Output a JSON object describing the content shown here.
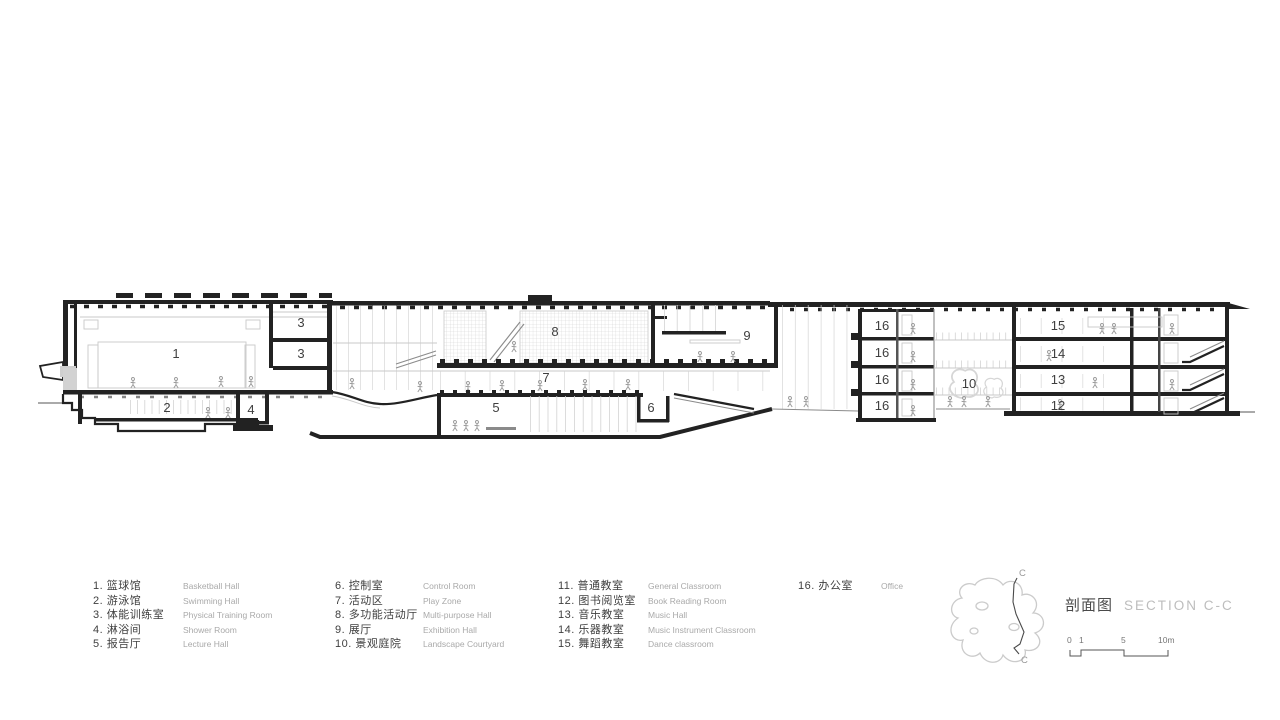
{
  "title": {
    "zh": "剖面图",
    "en": "SECTION C-C"
  },
  "legend": {
    "items": [
      {
        "label": "1. 篮球馆",
        "en": "Basketball Hall"
      },
      {
        "label": "2. 游泳馆",
        "en": "Swimming Hall"
      },
      {
        "label": "3. 体能训练室",
        "en": "Physical Training Room"
      },
      {
        "label": "4. 淋浴间",
        "en": "Shower Room"
      },
      {
        "label": "5. 报告厅",
        "en": "Lecture Hall"
      },
      {
        "label": "6. 控制室",
        "en": "Control Room"
      },
      {
        "label": "7. 活动区",
        "en": "Play Zone"
      },
      {
        "label": "8. 多功能活动厅",
        "en": "Multi-purpose Hall"
      },
      {
        "label": "9. 展厅",
        "en": "Exhibition Hall"
      },
      {
        "label": "10. 景观庭院",
        "en": "Landscape Courtyard"
      },
      {
        "label": "11. 普通教室",
        "en": "General Classroom"
      },
      {
        "label": "12. 图书阅览室",
        "en": "Book Reading Room"
      },
      {
        "label": "13. 音乐教室",
        "en": "Music Hall"
      },
      {
        "label": "14. 乐器教室",
        "en": "Music Instrument Classroom"
      },
      {
        "label": "15. 舞蹈教室",
        "en": "Dance classroom"
      },
      {
        "label": "16. 办公室",
        "en": "Office"
      }
    ]
  },
  "section": {
    "labels": [
      "1",
      "2",
      "3",
      "3",
      "4",
      "5",
      "6",
      "7",
      "8",
      "9",
      "16",
      "16",
      "16",
      "16",
      "10",
      "15",
      "14",
      "13",
      "12"
    ]
  },
  "key_plan": {
    "top": "C",
    "bottom": "C"
  },
  "scale_bar": {
    "t0": "0",
    "t1": "1",
    "t5": "5",
    "t10": "10m"
  },
  "colors": {
    "cut_line": "#222222",
    "light_line": "#c9c9c9",
    "label_text": "#3f3f3f",
    "english_text": "#a9a9a9",
    "title_en": "#bdbdbd",
    "background": "#ffffff"
  }
}
